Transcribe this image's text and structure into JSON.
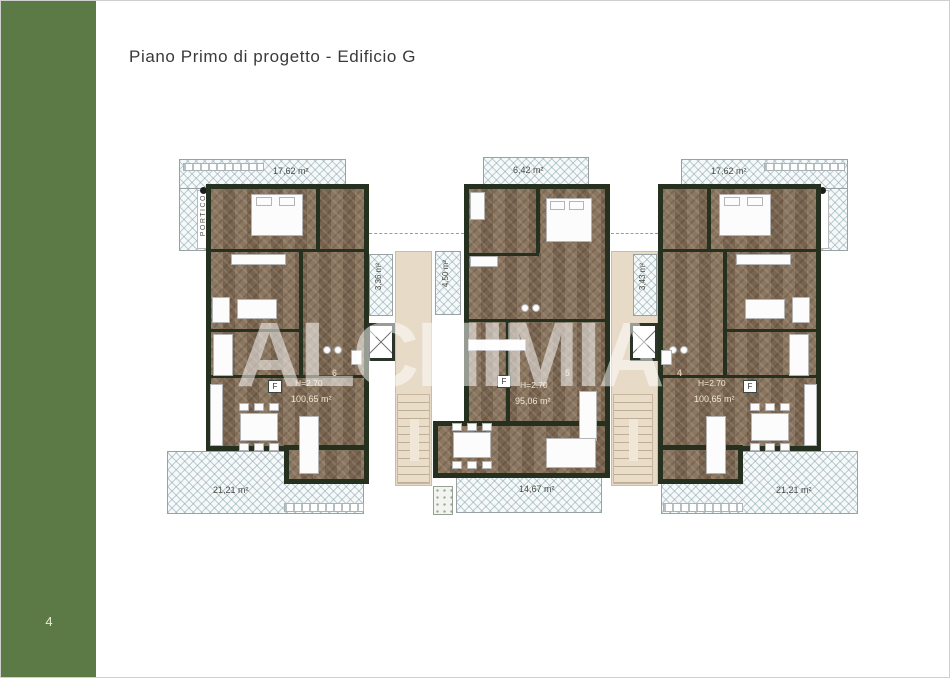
{
  "page": {
    "title": "Piano Primo di progetto - Edificio G",
    "page_number": "4",
    "watermark": "ALCHIMIA"
  },
  "colors": {
    "sidebar_green": "#5c7a45",
    "wall_dark_green": "#26301f",
    "floor_brown": "#85705a",
    "stair_core_beige": "#e7dac7",
    "terrace_hatch": "#aebfc6",
    "label_dark": "#4b4b44",
    "label_cream": "#efe7d2"
  },
  "plans": {
    "left": {
      "terrace_top_area": "17,62 m²",
      "portico": "PORTICO",
      "balcony_right_area": "3,36 m²",
      "terrace_bottom_area": "21,21 m²",
      "ceiling_height": "H=2.70",
      "apartment_area": "100,65 m²",
      "unit_number": "6",
      "f_label": "F"
    },
    "middle": {
      "balcony_top_area": "6,42 m²",
      "balcony_left_area": "4,50 m²",
      "terrace_bottom_area": "14,67 m²",
      "ceiling_height": "H=2.70",
      "apartment_area": "95,06 m²",
      "unit_number": "5",
      "f_label": "F"
    },
    "right": {
      "terrace_top_area": "17,62 m²",
      "portico": "PORTICO",
      "balcony_left_area": "3,43 m²",
      "terrace_bottom_area": "21,21 m²",
      "ceiling_height": "H=2.70",
      "apartment_area": "100,65 m²",
      "unit_number": "4",
      "f_label": "F"
    }
  }
}
